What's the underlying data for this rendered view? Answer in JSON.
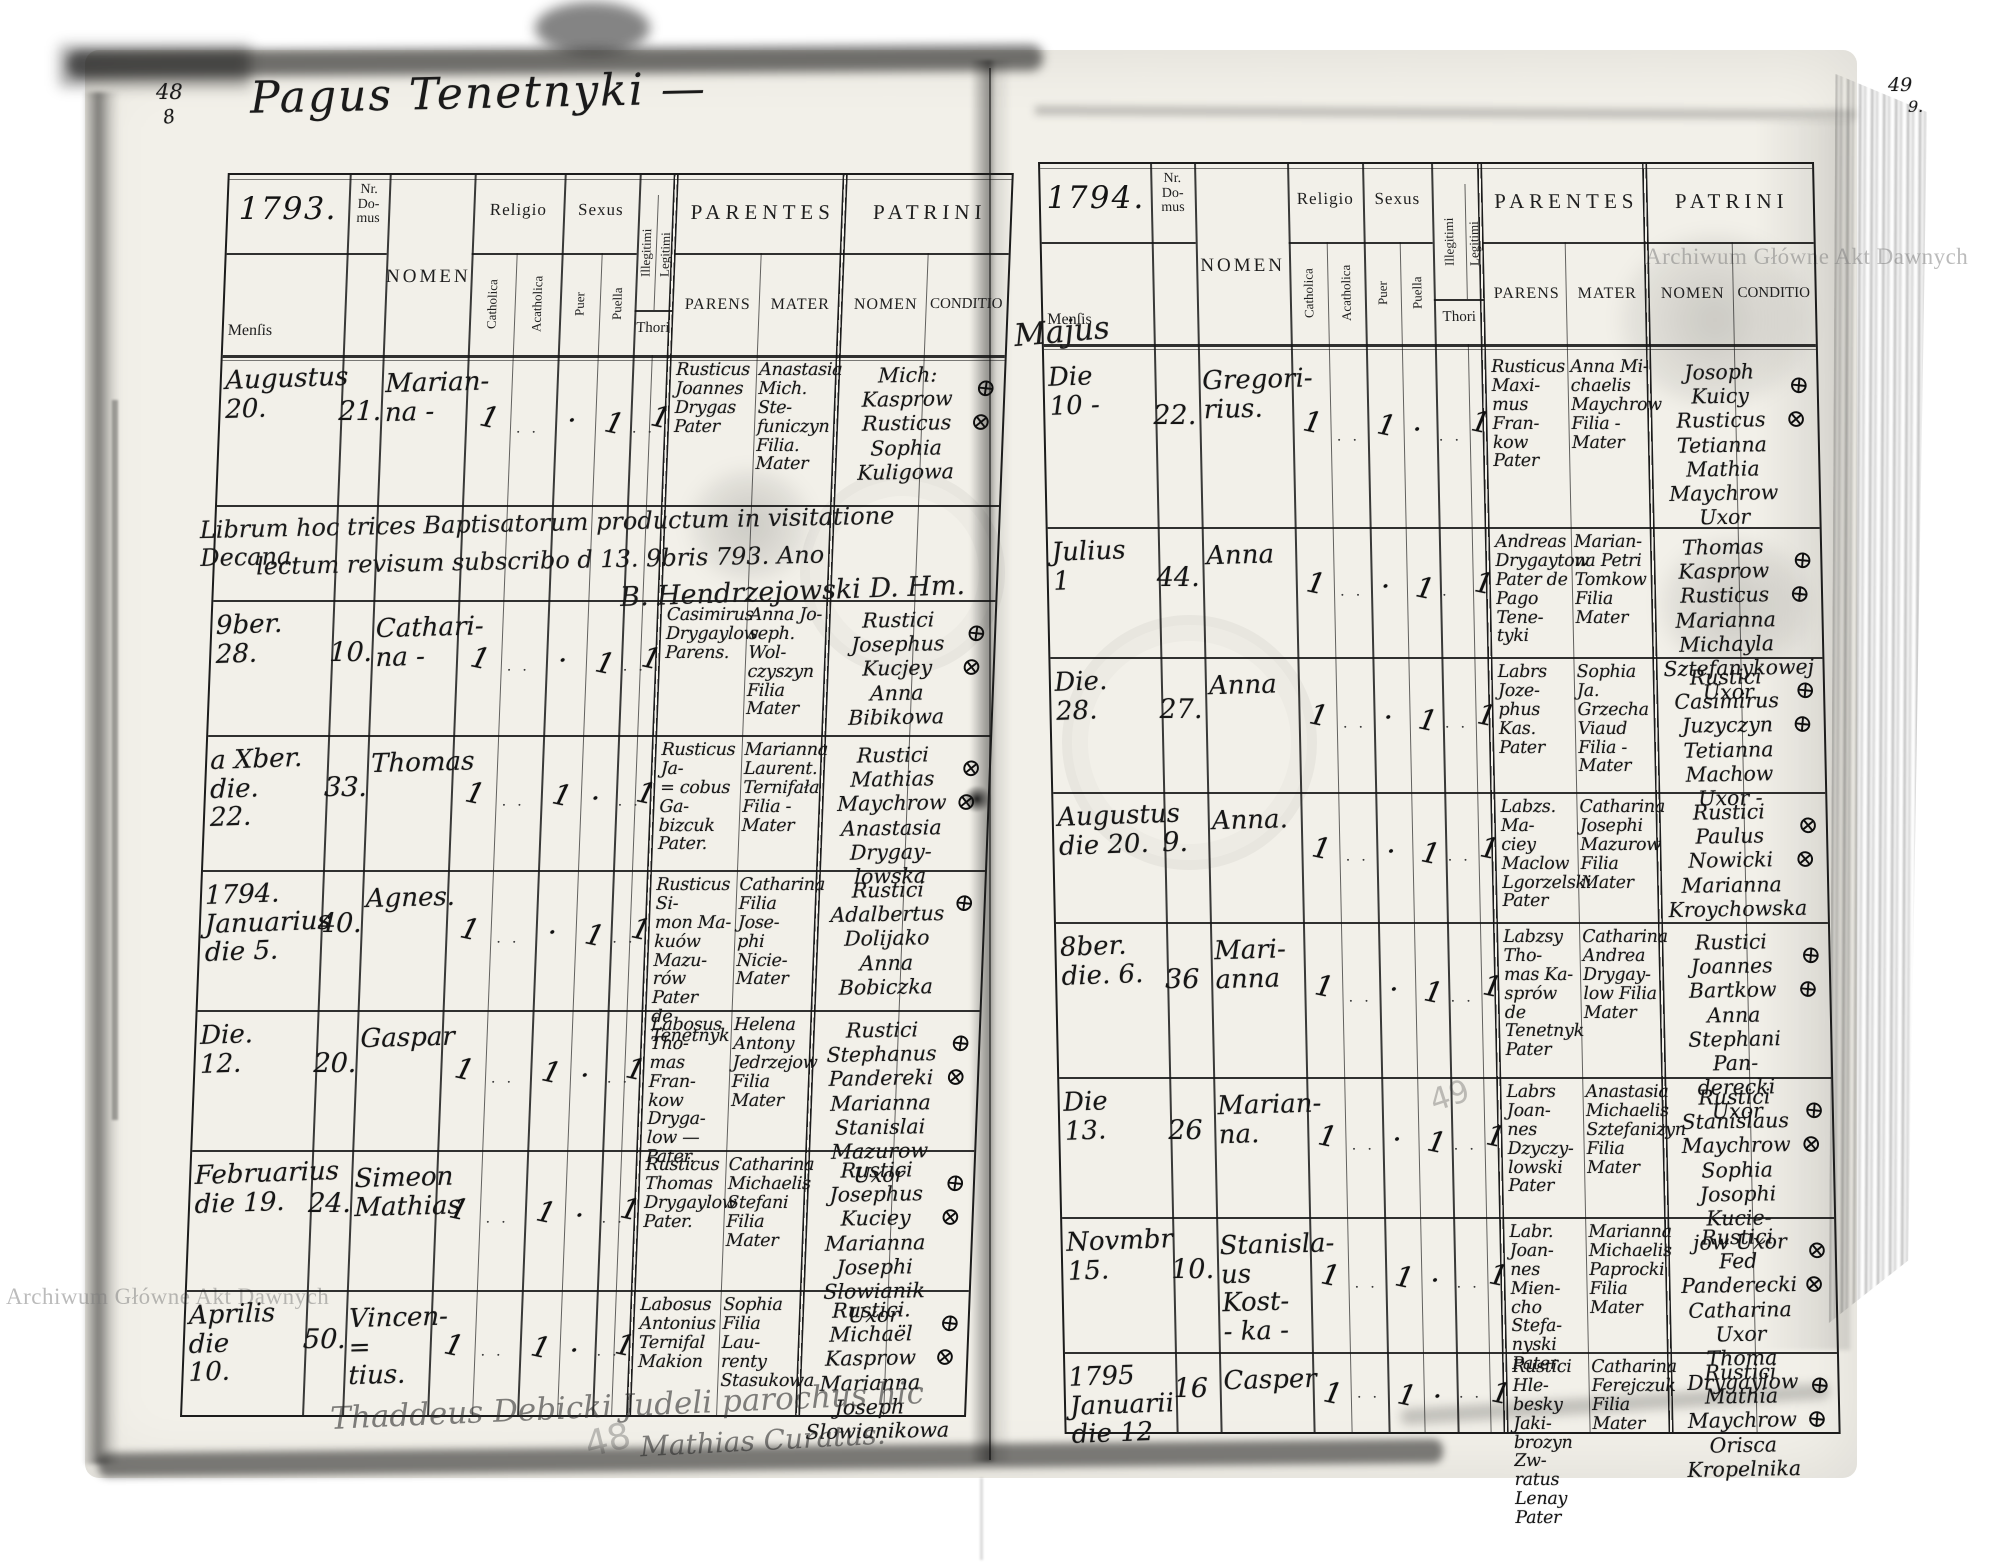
{
  "scan": {
    "watermark_top_right": "Archiwum Główne Akt Dawnych",
    "watermark_bottom_left": "Archiwum Główne Akt Dawnych"
  },
  "left_page": {
    "folio_ink": "48",
    "folio_ink_sub": "8",
    "folio_pencil": "48",
    "title": "Pagus Tenetnyki —",
    "header": {
      "year": "1793.",
      "nr_domus": "Nr. Do- mus",
      "nomen": "NOMEN",
      "mensis": "Menſis",
      "religio": "Religio",
      "catholica": "Catholica",
      "acatholica": "Acatholica",
      "sexus": "Sexus",
      "puer": "Puer",
      "puella": "Puella",
      "illegitimi": "Illegitimi",
      "legitimi": "Legitimi",
      "thori": "Thori",
      "parentes": "PARENTES",
      "parens": "PARENS",
      "mater": "MATER",
      "patrini": "PATRINI",
      "patrini_nomen": "NOMEN",
      "conditio": "CONDITIO"
    },
    "rows": [
      {
        "mensis": "Augustus\n20.",
        "nr": "21.",
        "nomen": "Marian-\nna -",
        "t_cath": "1",
        "t_acath": "· ·",
        "t_puer": "·",
        "t_puella": "1",
        "t_thori": "· ·",
        "t_leg": "1",
        "parens": "Rusticus\nJoannes\nDrygas\nPater",
        "mater": "Anastasia\nMich. Ste-\nfuniczyn\nFilia.\nMater",
        "patrini": "Mich: Kasprow\nRusticus\nSophia Kuligowa",
        "marks": "⊕\n⊗"
      },
      {
        "mensis": "9ber.\n28.",
        "nr": "10.",
        "nomen": "Cathari-\nna -",
        "t_cath": "1",
        "t_acath": "· ·",
        "t_puer": "·",
        "t_puella": "1",
        "t_thori": "· ·",
        "t_leg": "1",
        "parens": "Casimirus\nDrygaylow\nParens.",
        "mater": "Anna Jo-\nseph. Wol-\nczyszyn\nFilia\nMater",
        "patrini": "Rustici\nJosephus Kucjey\nAnna Bibikowa",
        "marks": "⊕\n⊗"
      },
      {
        "mensis": "a Xber.\ndie.\n22.",
        "nr": "33.",
        "nomen": "Thomas",
        "t_cath": "1",
        "t_acath": "· ·",
        "t_puer": "1",
        "t_puella": "·",
        "t_thori": "· ·",
        "t_leg": "1",
        "parens": "Rusticus Ja-\n= cobus Ga-\nbizcuk\nPater.",
        "mater": "Marianna\nLaurent.\nTernifała\nFilia -\nMater",
        "patrini": "Rustici\nMathias Maychrow\nAnastasia Drygay-\nlowska",
        "marks": "⊗\n⊗"
      },
      {
        "mensis": "1794.\nJanuarius\ndie 5.",
        "nr": "40.",
        "nomen": "Agnes.",
        "t_cath": "1",
        "t_acath": "· ·",
        "t_puer": "·",
        "t_puella": "1",
        "t_thori": "· ·",
        "t_leg": "1",
        "parens": "Rusticus Si-\nmon Ma-\nkuów Mazu-\nrów Pater\nde Tenetnyk",
        "mater": "Catharina\nFilia Jose-\nphi Nicie-\nMater",
        "patrini": "Rustici\nAdalbertus Dolijako\nAnna Bobiczka",
        "marks": "⊕"
      },
      {
        "mensis": "Die.\n12.",
        "nr": "20.",
        "nomen": "Gaspar",
        "t_cath": "1",
        "t_acath": "· ·",
        "t_puer": "1",
        "t_puella": "·",
        "t_thori": "· ·",
        "t_leg": "1",
        "parens": "Labosus Tho-\nmas Fran-\nkow Dryga-\nlow —\nPater.",
        "mater": "Helena\nAntony\nJedrzejow\nFilia\nMater",
        "patrini": "Rustici\nStephanus Pandereki\nMarianna Stanislai\nMazurow Uxor",
        "marks": "⊕\n⊗"
      },
      {
        "mensis": "Februarius\ndie 19.",
        "nr": "24.",
        "nomen": "Simeon\nMathias",
        "t_cath": "1",
        "t_acath": "· ·",
        "t_puer": "1",
        "t_puella": "·",
        "t_thori": "· ·",
        "t_leg": "1",
        "parens": "Rusticus\nThomas\nDrygaylow\nPater.",
        "mater": "Catharina\nMichaelis\nStefani\nFilia\nMater",
        "patrini": "Rustici\nJosephus Kuciey\nMarianna Josephi\nSlowianik Uxor",
        "marks": "⊕\n⊗"
      },
      {
        "mensis": "Aprilis\ndie\n10.",
        "nr": "50.",
        "nomen": "Vincen-\n= tius.",
        "t_cath": "1",
        "t_acath": "· ·",
        "t_puer": "1",
        "t_puella": "·",
        "t_thori": "· ·",
        "t_leg": "1",
        "parens": "Labosus\nAntonius\nTernifal\nMakion",
        "mater": "Sophia\nFilia Lau-\nrenty\nStasukowa",
        "patrini": "Rustici.\nMichaël Kasprow\nMarianna Joseph\nSlowianikowa",
        "marks": "⊕\n⊗"
      }
    ],
    "note": {
      "line1": "Librum hoc trices Baptisatorum productum in visitatione Decana.",
      "line2": "lectum revisum subscribo d 13. 9bris 793.   Ano",
      "sig": "B. Hendrzejowski D. Hm."
    },
    "bottom_note": {
      "line1": "Thaddeus Debicki Judeli parochus hic",
      "line2": "Mathias Curatus."
    }
  },
  "right_page": {
    "folio_ink": "49",
    "folio_ink_sub": "9.",
    "folio_pencil": "49",
    "mensis_written": "Majus",
    "header": {
      "year": "1794.",
      "nr_domus": "Nr. Do- mus",
      "nomen": "NOMEN",
      "mensis": "Menſis",
      "religio": "Religio",
      "catholica": "Catholica",
      "acatholica": "Acatholica",
      "sexus": "Sexus",
      "puer": "Puer",
      "puella": "Puella",
      "illegitimi": "Illegitimi",
      "legitimi": "Legitimi",
      "thori": "Thori",
      "parentes": "PARENTES",
      "parens": "PARENS",
      "mater": "MATER",
      "patrini": "PATRINI",
      "patrini_nomen": "NOMEN",
      "conditio": "CONDITIO"
    },
    "rows": [
      {
        "mensis": "Die\n10 -",
        "nr": "22.",
        "nomen": "Gregori-\nrius.",
        "t_cath": "1",
        "t_acath": "· ·",
        "t_puer": "1",
        "t_puella": "·",
        "t_thori": "· ·",
        "t_leg": "1",
        "parens": "Rusticus\nMaxi-\nmus Fran-\nkow\nPater",
        "mater": "Anna Mi-\nchaelis\nMaychrow\nFilia -\nMater",
        "patrini": "Josoph Kuicy\nRusticus\nTetianna Mathia\nMaychrow Uxor",
        "marks": "⊕\n⊗"
      },
      {
        "mensis": "Julius\n1",
        "nr": "44.",
        "nomen": "Anna",
        "t_cath": "1",
        "t_acath": "· ·",
        "t_puer": "·",
        "t_puella": "1",
        "t_thori": "·",
        "t_leg": "1",
        "parens": "Andreas\nDrygaytow\nPater de\nPago Tene-\ntyki",
        "mater": "Marian-\nna Petri\nTomkow\nFilia\nMater",
        "patrini": "Thomas Kasprow\nRusticus\nMarianna Michayla\nSztefanykowej Uxor",
        "marks": "⊕\n⊕"
      },
      {
        "mensis": "Die.\n28.",
        "nr": "27.",
        "nomen": "Anna",
        "t_cath": "1",
        "t_acath": "· ·",
        "t_puer": "·",
        "t_puella": "1",
        "t_thori": "· ·",
        "t_leg": "1",
        "parens": "Labrs Joze-\nphus Kas.\nPater",
        "mater": "Sophia Ja.\nGrzecha\nViaud\nFilia -\nMater",
        "patrini": "Rustici\nCasimirus Juzyczyn\nTetianna Machow\nUxor -",
        "marks": "⊕\n⊕"
      },
      {
        "mensis": "Augustus\ndie 20.",
        "nr": "9.",
        "nomen": "Anna.",
        "t_cath": "1",
        "t_acath": "· ·",
        "t_puer": "·",
        "t_puella": "1",
        "t_thori": "· ·",
        "t_leg": "1",
        "parens": "Labzs. Ma-\nciey Maclow\nLgorzelski\nPater",
        "mater": "Catharina\nJosephi\nMazurow\nFilia\nMater",
        "patrini": "Rustici\nPaulus Nowicki\nMarianna Kroychowska",
        "marks": "⊗\n⊗"
      },
      {
        "mensis": "8ber.\ndie. 6.",
        "nr": "36",
        "nomen": "Mari-\nanna",
        "t_cath": "1",
        "t_acath": "· ·",
        "t_puer": "·",
        "t_puella": "1",
        "t_thori": "· ·",
        "t_leg": "1",
        "parens": "Labzsy Tho-\nmas Ka-\nsprów de\nTenetnyk\nPater",
        "mater": "Catharina\nAndrea\nDrygay-\nlow Filia\nMater",
        "patrini": "Rustici\nJoannes Bartkow\nAnna Stephani Pan-\nderecki Uxor",
        "marks": "⊕\n⊕"
      },
      {
        "mensis": "Die\n13.",
        "nr": "26",
        "nomen": "Marian-\nna.",
        "t_cath": "1",
        "t_acath": "· ·",
        "t_puer": "·",
        "t_puella": "1",
        "t_thori": "· ·",
        "t_leg": "1",
        "parens": "Labrs Joan-\nnes Dzyczy-\nlowski\nPater",
        "mater": "Anastasia\nMichaelis\nSztefanizyn\nFilia\nMater",
        "patrini": "Rustici\nStanislaus Maychrow\nSophia Josophi Kucie-\njow Uxor",
        "marks": "⊕\n⊗"
      },
      {
        "mensis": "Novmbr\n15.",
        "nr": "10.",
        "nomen": "Stanisla-\nus Kost-\n- ka -",
        "t_cath": "1",
        "t_acath": "· ·",
        "t_puer": "1",
        "t_puella": "·",
        "t_thori": "· ·",
        "t_leg": "1",
        "parens": "Labr. Joan-\nnes Mien-\ncho Stefa-\nnyski Pater",
        "mater": "Marianna\nMichaelis\nPaprocki\nFilia\nMater",
        "patrini": "Rustici\nFed Panderecki\nCatharina Uxor Thoma\nDrygaylow",
        "marks": "⊗\n⊗"
      },
      {
        "mensis": "1795\nJanuarii\ndie 12",
        "nr": "16",
        "nomen": "Casper",
        "t_cath": "1",
        "t_acath": "· ·",
        "t_puer": "1",
        "t_puella": "·",
        "t_thori": "· ·",
        "t_leg": "1",
        "parens": "Rustici Hle-\nbesky Jaki-\nbrozyn Zw-\nratus Lenay\nPater",
        "mater": "Catharina\nFerejczuk\nFilia\nMater",
        "patrini": "Rustici\nMathia Maychrow\nOrisca Kropelnika",
        "marks": "⊕\n⊕"
      }
    ]
  }
}
